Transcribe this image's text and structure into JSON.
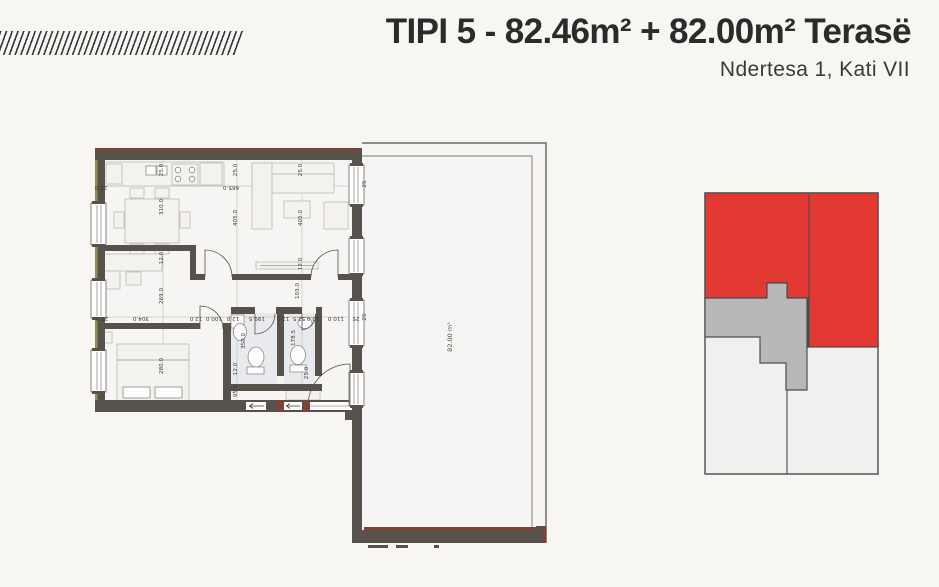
{
  "header": {
    "title": "TIPI 5 - 82.46m² + 82.00m² Terasë",
    "subtitle": "Ndertesa 1, Kati VII"
  },
  "plan": {
    "terrace_label": "82.00 m²",
    "colors": {
      "wall": "#57534c",
      "brick": "#7c4437",
      "olive": "#938d52"
    },
    "dimensions": [
      {
        "t": "25.0",
        "x": 163,
        "y": 170,
        "r": -90
      },
      {
        "t": "310.0",
        "x": 163,
        "y": 207,
        "r": -90
      },
      {
        "t": "12.0",
        "x": 163,
        "y": 258,
        "r": -90
      },
      {
        "t": "269.0",
        "x": 163,
        "y": 296,
        "r": -90
      },
      {
        "t": "280.0",
        "x": 163,
        "y": 366,
        "r": -90
      },
      {
        "t": "25.0",
        "x": 237,
        "y": 170,
        "r": -90
      },
      {
        "t": "405.0",
        "x": 237,
        "y": 218,
        "r": -90
      },
      {
        "t": "12.0",
        "x": 237,
        "y": 369,
        "r": -90
      },
      {
        "t": "95.0",
        "x": 237,
        "y": 391,
        "r": -90
      },
      {
        "t": "350.0",
        "x": 245,
        "y": 341,
        "r": -90
      },
      {
        "t": "25.0",
        "x": 302,
        "y": 170,
        "r": -90
      },
      {
        "t": "405.0",
        "x": 302,
        "y": 218,
        "r": -90
      },
      {
        "t": "12.0",
        "x": 302,
        "y": 264,
        "r": -90
      },
      {
        "t": "103.0",
        "x": 299,
        "y": 291,
        "r": -90
      },
      {
        "t": "178.5",
        "x": 295,
        "y": 338,
        "r": -90
      },
      {
        "t": "25.0",
        "x": 308,
        "y": 373,
        "r": -90
      },
      {
        "t": "25",
        "x": 366,
        "y": 184,
        "r": -90
      },
      {
        "t": "25",
        "x": 366,
        "y": 317,
        "r": -90
      },
      {
        "t": "25.0",
        "x": 101,
        "y": 186,
        "r": 180
      },
      {
        "t": "665.0",
        "x": 231,
        "y": 186,
        "r": 180
      },
      {
        "t": "25.0",
        "x": 102,
        "y": 317,
        "r": 180
      },
      {
        "t": "304.0",
        "x": 141,
        "y": 317,
        "r": 180
      },
      {
        "t": "12.0",
        "x": 196,
        "y": 317,
        "r": 180
      },
      {
        "t": "100.0",
        "x": 214,
        "y": 317,
        "r": 180
      },
      {
        "t": "12.0",
        "x": 233,
        "y": 317,
        "r": 180
      },
      {
        "t": "199.5",
        "x": 257,
        "y": 317,
        "r": 180
      },
      {
        "t": "12.0",
        "x": 283,
        "y": 317,
        "r": 180
      },
      {
        "t": "52.5",
        "x": 299,
        "y": 317,
        "r": 180
      },
      {
        "t": "12.0",
        "x": 313,
        "y": 317,
        "r": 180
      },
      {
        "t": "110.0",
        "x": 336,
        "y": 317,
        "r": 180
      },
      {
        "t": "25",
        "x": 356,
        "y": 317,
        "r": 180
      }
    ]
  },
  "minimap": {
    "colors": {
      "maphl": "#e23a33",
      "mapcore": "#b9b7b9",
      "mapother": "#f1f0ee",
      "mapline": "#4c4c4e"
    }
  }
}
